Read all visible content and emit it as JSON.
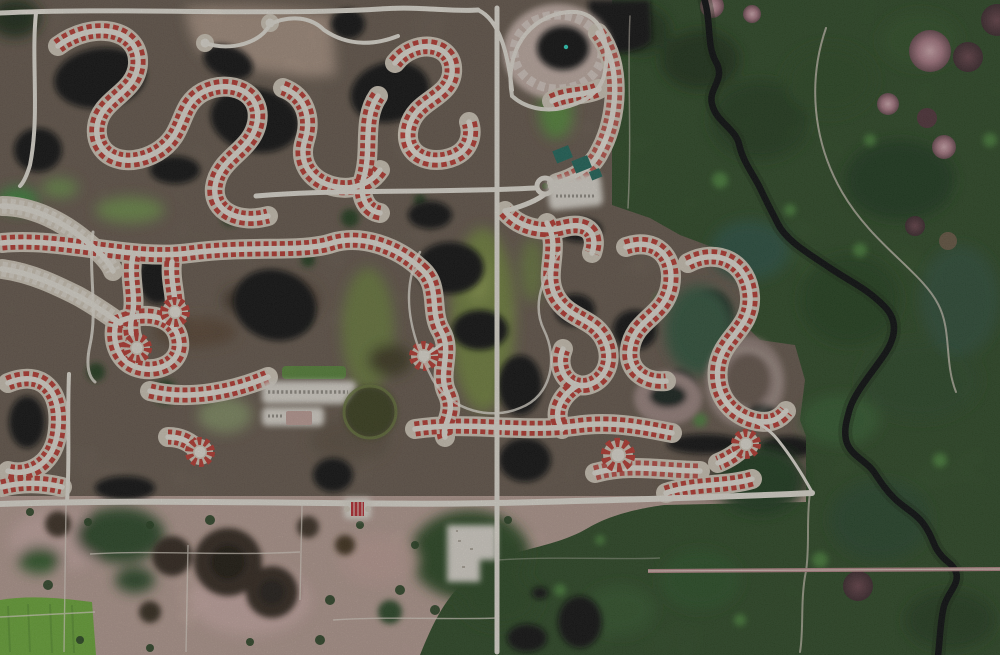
{
  "scene": {
    "type": "aerial-satellite-photograph",
    "description": "Top-down aerial view of a master-planned residential golf community: looping white streets lined with red-roofed homes around black retention ponds and olive fairways; a clubhouse with teal courts and a roundabout; a horseshoe-shaped construction oval; bordered east by forested wetland cut by a dark meandering creek with pink tree hammocks, and south by rural pasture with dark tree clumps, dirt tracks and a bright green field.",
    "regions": [
      {
        "name": "residential-development",
        "position": "north-west two thirds"
      },
      {
        "name": "forested-wetland",
        "position": "east third"
      },
      {
        "name": "meandering-creek",
        "position": "runs north-south through wetland"
      },
      {
        "name": "rural-pasture",
        "position": "south-west below boundary road"
      },
      {
        "name": "clubhouse-complex",
        "position": "center, with roundabout and teal courts"
      },
      {
        "name": "construction-oval",
        "position": "north, horseshoe of cleared land around pond"
      },
      {
        "name": "amenity-parking",
        "position": "center-west"
      },
      {
        "name": "entry-gate-structure",
        "position": "south-center on boundary road"
      }
    ]
  },
  "palette": {
    "dev_ground": "#6a5c4f",
    "dev_dark": "#463c31",
    "bare_tan": "#b59c8b",
    "pond": "#0a0e09",
    "road": "#f1ece1",
    "lot": "#dcd2c2",
    "house_red": "#c23a31",
    "house_white": "#eae3d7",
    "forest": "#2c4a24",
    "forest_dark": "#1c3317",
    "forest_teal": "#2c523f",
    "forest_bright": "#4e8a3c",
    "creek": "#05080a",
    "fairway": "#77883f",
    "fairway_light": "#95a552",
    "pasture": "#bfa499",
    "pasture_pink": "#d3b2ac",
    "field_green": "#6fb038",
    "tree_clump": "#32271c",
    "tree_dark": "#1f170f",
    "dirt_pink": "#bd8d8d",
    "hammock_pink": "#c08d96",
    "hammock_dark": "#5d3f45",
    "court_teal": "#1f6b5e",
    "fountain_teal": "#2ee0c8",
    "construction": "#cdb8ae",
    "building_white": "#e9e4da",
    "gate_red": "#c2272f"
  }
}
